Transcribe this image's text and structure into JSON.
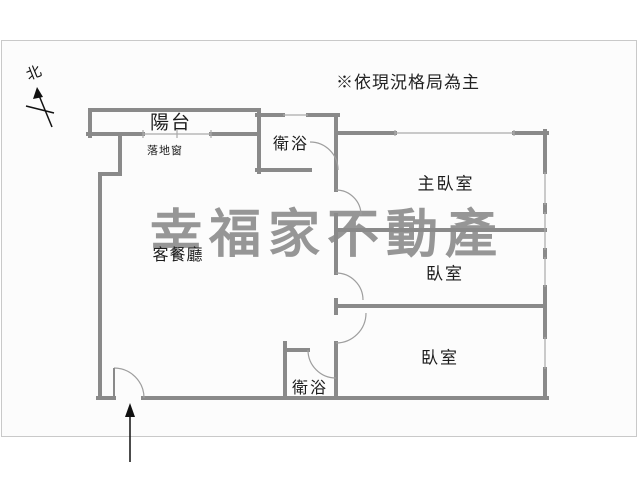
{
  "notice": {
    "text": "※依現況格局為主"
  },
  "compass": {
    "label": "北"
  },
  "watermark": {
    "text": "幸福家不動產",
    "color": "#969696"
  },
  "rooms": {
    "balcony": {
      "label": "陽台"
    },
    "sliding_window": {
      "label": "落地窗"
    },
    "bathroom_top": {
      "label": "衛浴"
    },
    "master_bedroom": {
      "label": "主臥室"
    },
    "living_dining": {
      "label": "客餐廳"
    },
    "bedroom_1": {
      "label": "臥室"
    },
    "bedroom_2": {
      "label": "臥室"
    },
    "bathroom_bottom": {
      "label": "衛浴"
    }
  },
  "colors": {
    "wall": "#8a8a8a",
    "window_line": "#aaaaaa",
    "door_arc": "#9e9e9e",
    "frame_border": "#c9c9c9",
    "label_text": "#1c1c1c"
  }
}
